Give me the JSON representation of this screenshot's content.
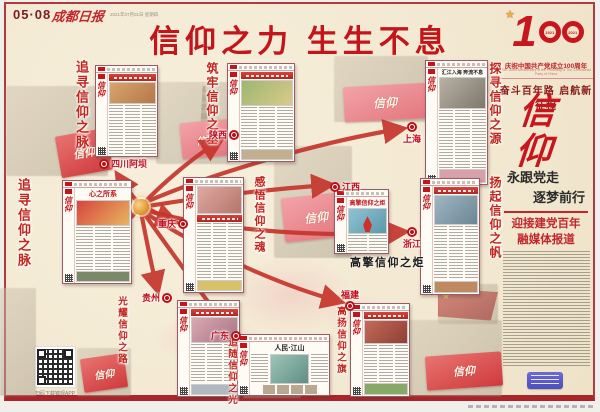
{
  "page": {
    "page_no": "05·08",
    "masthead": "成都日报",
    "dateline": "2021年07月01日 星期四",
    "main_title": "信仰之力  生生不息"
  },
  "right_column": {
    "logo_big": "1",
    "logo_year_left": "1921",
    "logo_year_right": "2021",
    "anniv_cn": "庆祝中国共产党成立100周年",
    "anniv_en": "The 100th Anniversary of the Founding of The Communist Party of China",
    "slogan": "奋斗百年路 启航新征程",
    "calligraphy": "信仰",
    "subtitle_line1": "永跟党走",
    "subtitle_line2": "逐梦前行",
    "series_line1": "迎接建党百年",
    "series_line2": "融媒体报道"
  },
  "footer": {
    "qr_caption": "扫码下载锦观APP"
  },
  "banner_text": "信仰",
  "colors": {
    "accent_red": "#c3151c",
    "arrow_red": "#c5352c",
    "paper_cream": "#f4ebd6",
    "frame_red": "#b23a3e",
    "hub_orange": "#e09a33"
  },
  "hub": {
    "x": 141,
    "y": 207
  },
  "section_titles": [
    {
      "text": "追寻信仰之脉",
      "x": 72,
      "y": 60,
      "size": 13
    },
    {
      "text": "追寻信仰之脉",
      "x": 14,
      "y": 178,
      "size": 13
    },
    {
      "text": "筑牢信仰之基",
      "x": 204,
      "y": 62,
      "size": 12
    },
    {
      "text": "探寻信仰之源",
      "x": 487,
      "y": 62,
      "size": 12
    },
    {
      "text": "感悟信仰之魂",
      "x": 251,
      "y": 176,
      "size": 11
    },
    {
      "text": "扬起信仰之帆",
      "x": 487,
      "y": 176,
      "size": 12
    },
    {
      "text": "光耀信仰之路",
      "x": 114,
      "y": 296,
      "size": 9.5
    },
    {
      "text": "追随信仰之光",
      "x": 224,
      "y": 337,
      "size": 9.5
    },
    {
      "text": "高扬信仰之旗",
      "x": 333,
      "y": 306,
      "size": 9.5
    }
  ],
  "labels": [
    {
      "text": "四川阿坝",
      "x": 99,
      "y": 157,
      "icon": "left"
    },
    {
      "text": "陕西",
      "x": 209,
      "y": 128,
      "icon": "right"
    },
    {
      "text": "上海",
      "x": 403,
      "y": 122,
      "icon": "top"
    },
    {
      "text": "重庆",
      "x": 158,
      "y": 217,
      "icon": "right"
    },
    {
      "text": "江西",
      "x": 330,
      "y": 180,
      "icon": "left"
    },
    {
      "text": "浙江",
      "x": 403,
      "y": 227,
      "icon": "top"
    },
    {
      "text": "贵州",
      "x": 142,
      "y": 291,
      "icon": "right"
    },
    {
      "text": "广东",
      "x": 211,
      "y": 329,
      "icon": "right"
    },
    {
      "text": "福建",
      "x": 341,
      "y": 288,
      "icon": "bottom"
    }
  ],
  "captions": [
    {
      "text": "高擎信仰之炬",
      "x": 350,
      "y": 254,
      "size": 11
    }
  ],
  "thumbnails": [
    {
      "id": "abazhou",
      "region": "四川阿坝",
      "x": 95,
      "y": 65,
      "w": 63,
      "h": 92,
      "headline": null,
      "hstyle": null,
      "hsize": 0,
      "hbox": true,
      "photo_first": false,
      "photo": "linear-gradient(135deg,#d8a56a,#b5774a)",
      "photo_h": 20,
      "photo2": null,
      "photo2_h": 0,
      "cols": 3,
      "wide": false,
      "torch": false
    },
    {
      "id": "liangshan",
      "region": "四川凉山",
      "x": 62,
      "y": 180,
      "w": 70,
      "h": 104,
      "headline": "心之所系",
      "hstyle": "red",
      "hsize": 7,
      "hbox": false,
      "photo_first": false,
      "photo": "linear-gradient(135deg,#d8453f,#e8b55f)",
      "photo_h": 24,
      "photo2": "#7a8a68",
      "photo2_h": 9,
      "cols": 3,
      "wide": false,
      "torch": false
    },
    {
      "id": "shaanxi",
      "region": "陕西",
      "x": 227,
      "y": 63,
      "w": 68,
      "h": 99,
      "headline": null,
      "hstyle": null,
      "hsize": 0,
      "hbox": true,
      "photo_first": false,
      "photo": "linear-gradient(135deg,#9db86e,#d9c98a)",
      "photo_h": 24,
      "photo2": "#c0b090",
      "photo2_h": 9,
      "cols": 3,
      "wide": false,
      "torch": false
    },
    {
      "id": "shanghai",
      "region": "上海",
      "x": 425,
      "y": 60,
      "w": 63,
      "h": 125,
      "headline": "汇江入海 奔流不息",
      "hstyle": "dark",
      "hsize": 5,
      "hbox": false,
      "photo_first": false,
      "photo": "linear-gradient(135deg,#b8b2a4,#7e786d)",
      "photo_h": 30,
      "photo2": "#d8a0a8",
      "photo2_h": 12,
      "cols": 3,
      "wide": false,
      "torch": false
    },
    {
      "id": "chongqing",
      "region": "重庆",
      "x": 183,
      "y": 177,
      "w": 61,
      "h": 116,
      "headline": null,
      "hstyle": null,
      "hsize": 0,
      "hbox": true,
      "photo_first": true,
      "photo": "linear-gradient(135deg,#e0a9a0,#b4756c)",
      "photo_h": 26,
      "photo2": "#d9c06a",
      "photo2_h": 9,
      "cols": 3,
      "wide": false,
      "torch": false
    },
    {
      "id": "jiangxi",
      "region": "江西",
      "x": 334,
      "y": 189,
      "w": 55,
      "h": 65,
      "headline": "高擎信仰之炬",
      "hstyle": "red",
      "hsize": 6,
      "hbox": false,
      "photo_first": false,
      "photo": "linear-gradient(135deg,#8fc3d4,#5d98ab)",
      "photo_h": 24,
      "photo2": null,
      "photo2_h": 0,
      "cols": 2,
      "wide": false,
      "torch": true
    },
    {
      "id": "zhejiang",
      "region": "浙江",
      "x": 420,
      "y": 178,
      "w": 60,
      "h": 117,
      "headline": null,
      "hstyle": null,
      "hsize": 0,
      "hbox": true,
      "photo_first": false,
      "photo": "linear-gradient(135deg,#9fb6c4,#6c8694)",
      "photo_h": 28,
      "photo2": "#c08a60",
      "photo2_h": 10,
      "cols": 3,
      "wide": false,
      "torch": false
    },
    {
      "id": "guizhou",
      "region": "贵州",
      "x": 177,
      "y": 300,
      "w": 63,
      "h": 97,
      "headline": null,
      "hstyle": null,
      "hsize": 0,
      "hbox": true,
      "photo_first": false,
      "photo": "linear-gradient(135deg,#d9a8b2,#a87484)",
      "photo_h": 24,
      "photo2": "#b0b8c0",
      "photo2_h": 9,
      "cols": 3,
      "wide": false,
      "torch": false
    },
    {
      "id": "guangdong",
      "region": "广东",
      "x": 237,
      "y": 334,
      "w": 93,
      "h": 62,
      "headline": "人民·江山",
      "hstyle": "dark",
      "hsize": 7,
      "hbox": false,
      "photo_first": false,
      "photo": "linear-gradient(135deg,#9ec4b8,#5f8f84)",
      "photo_h": 0,
      "photo2": null,
      "photo2_h": 0,
      "cols": 2,
      "wide": true,
      "torch": false
    },
    {
      "id": "fujian",
      "region": "福建",
      "x": 350,
      "y": 303,
      "w": 60,
      "h": 94,
      "headline": null,
      "hstyle": null,
      "hsize": 0,
      "hbox": true,
      "photo_first": false,
      "photo": "linear-gradient(135deg,#c46a5a,#8f3f34)",
      "photo_h": 22,
      "photo2": "#88a868",
      "photo2_h": 10,
      "cols": 3,
      "wide": false,
      "torch": false
    }
  ],
  "ghost_photos": [
    {
      "x": 6,
      "y": 86,
      "w": 102,
      "h": 90
    },
    {
      "x": 156,
      "y": 82,
      "w": 74,
      "h": 82
    },
    {
      "x": 334,
      "y": 56,
      "w": 94,
      "h": 66
    },
    {
      "x": 274,
      "y": 146,
      "w": 78,
      "h": 112
    },
    {
      "x": 77,
      "y": 348,
      "w": 54,
      "h": 48
    },
    {
      "x": 243,
      "y": 356,
      "w": 58,
      "h": 42
    },
    {
      "x": 408,
      "y": 320,
      "w": 94,
      "h": 76
    },
    {
      "x": 438,
      "y": 284,
      "w": 60,
      "h": 40
    },
    {
      "x": 0,
      "y": 288,
      "w": 36,
      "h": 108
    }
  ],
  "banners": [
    {
      "x": 58,
      "y": 132,
      "w": 52,
      "h": 42,
      "rot": -10,
      "light": false,
      "fs": 11
    },
    {
      "x": 181,
      "y": 121,
      "w": 50,
      "h": 36,
      "rot": -5,
      "light": true,
      "fs": 10
    },
    {
      "x": 344,
      "y": 85,
      "w": 82,
      "h": 35,
      "rot": -3,
      "light": true,
      "fs": 12
    },
    {
      "x": 283,
      "y": 195,
      "w": 66,
      "h": 44,
      "rot": -6,
      "light": true,
      "fs": 12
    },
    {
      "x": 82,
      "y": 356,
      "w": 44,
      "h": 34,
      "rot": -8,
      "light": false,
      "fs": 10
    },
    {
      "x": 426,
      "y": 354,
      "w": 76,
      "h": 34,
      "rot": -4,
      "light": false,
      "fs": 11
    },
    {
      "x": 248,
      "y": 364,
      "w": 46,
      "h": 28,
      "rot": -6,
      "light": false,
      "fs": 9
    }
  ],
  "swirls": [
    {
      "x": 225,
      "y": 255,
      "w": 130,
      "h": 80,
      "o": 0.3
    },
    {
      "x": 150,
      "y": 315,
      "w": 120,
      "h": 50,
      "o": 0.25
    },
    {
      "x": 320,
      "y": 290,
      "w": 70,
      "h": 50,
      "o": 0.2
    },
    {
      "x": 420,
      "y": 248,
      "w": 60,
      "h": 40,
      "o": 0.2
    }
  ],
  "arrows": [
    "M141,206 C133,197 126,188 119,177",
    "M144,203 C162,184 192,158 218,142",
    "M146,202 C220,170 330,140 400,129",
    "M149,209 C158,214 165,218 173,221",
    "M148,206 C210,196 272,189 328,185",
    "M148,211 C230,233 330,237 402,232",
    "M137,211 C126,223 112,237 99,247",
    "M141,212 C146,238 151,264 157,288",
    "M143,212 C170,250 200,292 225,324",
    "M144,212 C210,256 290,288 338,301"
  ]
}
